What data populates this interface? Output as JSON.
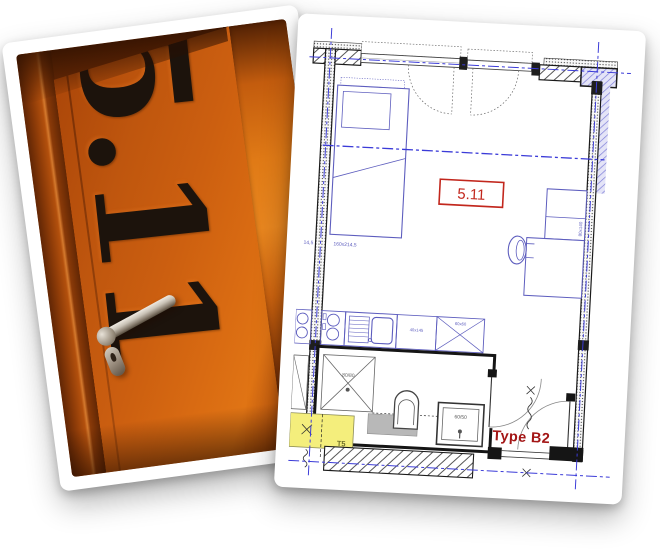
{
  "scene": {
    "description": "Photo collage: orange door of room 5.11 and apartment floor plan",
    "background": "#ffffff"
  },
  "door_photo": {
    "room_number": "5.11",
    "door_color": "#c85c0f",
    "number_color": "#1c130c"
  },
  "floor_plan": {
    "room_label": "5.11",
    "type_label": "Type B2",
    "labels": {
      "shower_dim": "80/80",
      "basin_dim": "60/50",
      "zone_tag": "T5",
      "bed_dim_left": "14,5",
      "bed_dim": "160x214,5",
      "counter_dim": "40x145",
      "unit_dim": "60x60",
      "desk_dim": "80x140"
    },
    "colors": {
      "furniture_blue": "#5d5dbe",
      "axis_blue": "#3b3bd8",
      "highlight_red": "#c2271d",
      "type_red": "#a31515",
      "zone_yellow": "#f4ee7c",
      "wall_black": "#151515"
    }
  }
}
